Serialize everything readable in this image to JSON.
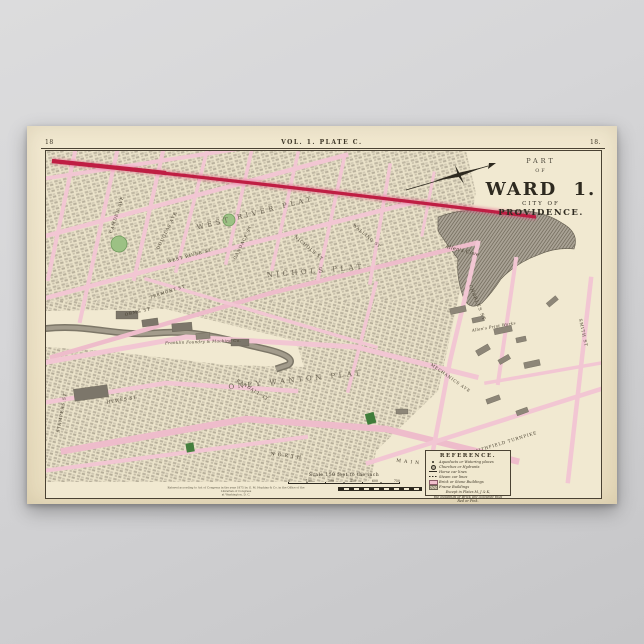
{
  "poster": {
    "plate_header": {
      "page_left": "18",
      "volume": "VOL. 1. PLATE C.",
      "page_right": "18."
    },
    "title_block": {
      "part": "PART",
      "of": "OF",
      "ward": "WARD 1.",
      "city": "CITY OF",
      "name": "PROVIDENCE."
    },
    "map": {
      "colors": {
        "paper": "#f1e9d1",
        "street_pink": "#f2c6d3",
        "water_gray": "#a39c8c",
        "park_green": "#9cc184",
        "red_line": "#bf1e43",
        "ink": "#3c3526"
      },
      "labels": [
        {
          "text": "CAMDEN AVE",
          "x": 72,
          "y": 64,
          "r": -72,
          "s": 4.2,
          "cls": "st"
        },
        {
          "text": "DOUGLAS AVE",
          "x": 122,
          "y": 80,
          "r": -64,
          "s": 4.2,
          "cls": "st"
        },
        {
          "text": "CANDACE ST",
          "x": 198,
          "y": 92,
          "r": -64,
          "s": 4.2,
          "cls": "st"
        },
        {
          "text": "WEST RIVER ST",
          "x": 144,
          "y": 106,
          "r": -15,
          "s": 4.2,
          "cls": "st"
        },
        {
          "text": "ORMS ST",
          "x": 92,
          "y": 162,
          "r": -13,
          "s": 4.2,
          "cls": "st"
        },
        {
          "text": "TREMONT ST",
          "x": 122,
          "y": 142,
          "r": -18,
          "s": 4,
          "cls": "st"
        },
        {
          "text": "NICHOLS ST",
          "x": 262,
          "y": 98,
          "r": 40,
          "s": 4.2,
          "cls": "st"
        },
        {
          "text": "WALLING ST",
          "x": 320,
          "y": 86,
          "r": 40,
          "s": 4,
          "cls": "st"
        },
        {
          "text": "RANDALL ST",
          "x": 206,
          "y": 240,
          "r": 32,
          "s": 4.2,
          "cls": "st"
        },
        {
          "text": "HEWES ST",
          "x": 76,
          "y": 250,
          "r": -10,
          "s": 4.2,
          "cls": "st"
        },
        {
          "text": "STAMPERS ST",
          "x": 17,
          "y": 262,
          "r": -80,
          "s": 4.2,
          "cls": "st"
        },
        {
          "text": "N O R T H",
          "x": 240,
          "y": 306,
          "r": 7,
          "s": 4.6,
          "cls": "st"
        },
        {
          "text": "M A I N",
          "x": 362,
          "y": 312,
          "r": 6,
          "s": 4.6,
          "cls": "st"
        },
        {
          "text": "CHARLES ST",
          "x": 430,
          "y": 152,
          "r": 68,
          "s": 4.4,
          "cls": "st"
        },
        {
          "text": "MECHANICS AVE",
          "x": 404,
          "y": 228,
          "r": 35,
          "s": 4,
          "cls": "st"
        },
        {
          "text": "SMITHFIELD TURNPIKE",
          "x": 458,
          "y": 293,
          "r": -17,
          "s": 4.2,
          "cls": "st"
        },
        {
          "text": "SMITH ST",
          "x": 536,
          "y": 182,
          "r": 78,
          "s": 4.2,
          "cls": "st"
        },
        {
          "text": "WEST RIVER PLAT",
          "x": 210,
          "y": 64,
          "r": -14,
          "s": 7,
          "cls": "plat"
        },
        {
          "text": "NICHOLS PLAT",
          "x": 270,
          "y": 122,
          "r": -5,
          "s": 7,
          "cls": "plat"
        },
        {
          "text": "ONEY WANTON PLAT",
          "x": 250,
          "y": 231,
          "r": -6,
          "s": 7,
          "cls": "plat"
        },
        {
          "text": "Allen's Cove",
          "x": 416,
          "y": 101,
          "r": 14,
          "s": 5,
          "cls": "it"
        },
        {
          "text": "Franklin Foundry & Machine Co.",
          "x": 157,
          "y": 192,
          "r": -2,
          "s": 4,
          "cls": "it"
        },
        {
          "text": "Allen's Print Works",
          "x": 448,
          "y": 177,
          "r": -10,
          "s": 4,
          "cls": "it"
        }
      ]
    },
    "legend": {
      "title": "REFERENCE.",
      "rows": [
        {
          "sym": "dot",
          "text": "Aqueducts or Watering places"
        },
        {
          "sym": "target",
          "text": "Churches or Hydrants"
        },
        {
          "sym": "line",
          "text": "Horse car lines"
        },
        {
          "sym": "dash",
          "text": "Steam car lines"
        },
        {
          "sym": "brick",
          "text": "Brick or Stone Buildings"
        },
        {
          "sym": "frame",
          "text": "Frame Buildings"
        }
      ],
      "footnote_1": "Except in Plates M, J & K,",
      "footnote_2": "the buildings of Brick are coloured thus",
      "footnote_3": "Red or Pink."
    },
    "scale": {
      "text": "Scale 150 feet to the inch",
      "ticks": [
        "0",
        "150",
        "300",
        "450",
        "600",
        "750"
      ]
    },
    "copyright": {
      "line1": "Entered according to Act of Congress in the year 1875 by G. M. Hopkins & Co. in the Office of the Librarian of Congress",
      "line2": "at Washington, D. C."
    }
  }
}
